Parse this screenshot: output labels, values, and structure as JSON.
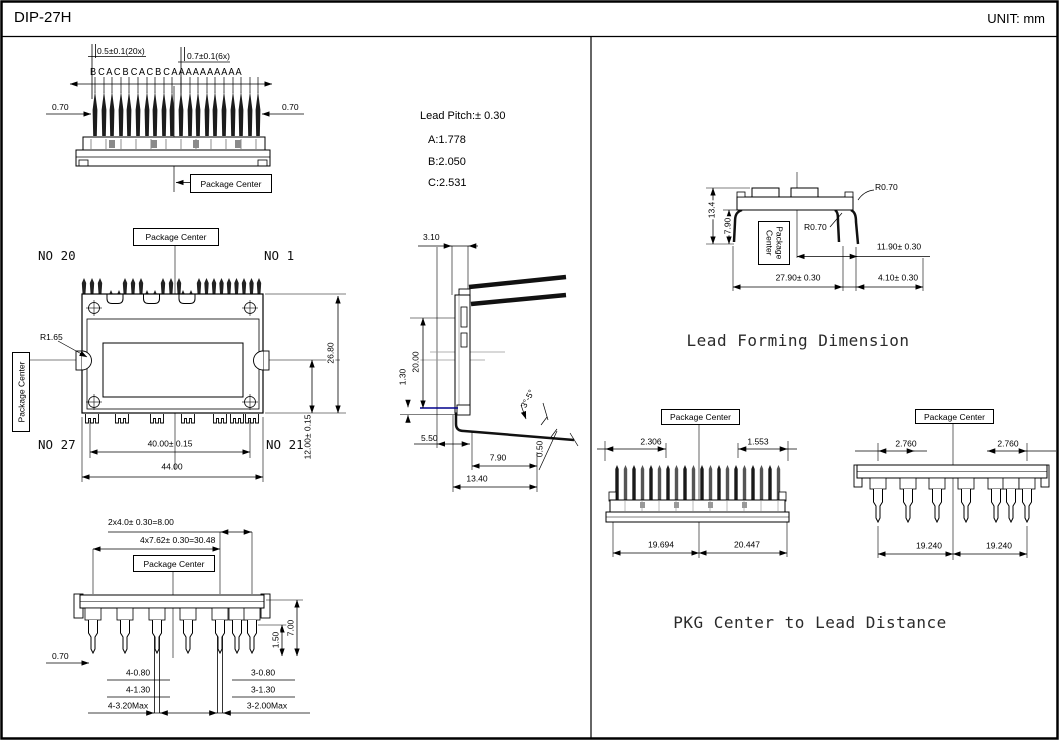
{
  "header": {
    "title": "DIP-27H",
    "unit": "UNIT: mm"
  },
  "front_view": {
    "pin_labels": "B C A C B C A C B C A A A A A A A A A A",
    "dim_tip20": "0.5±0.1(20x)",
    "dim_tip6": "0.7±0.1(6x)",
    "dim_left": "0.70",
    "dim_right": "0.70",
    "package_center": "Package Center"
  },
  "lead_pitch": {
    "title": "Lead Pitch:± 0.30",
    "a": "A:1.778",
    "b": "B:2.050",
    "c": "C:2.531"
  },
  "plan_view": {
    "package_center": "Package Center",
    "package_center_side": "Package Center",
    "no20": "NO 20",
    "no1": "NO 1",
    "no27": "NO 27",
    "no21": "NO 21",
    "radius": "R1.65",
    "lead_span": "40.00± 0.15",
    "body_width": "44.00",
    "body_height": "26.80",
    "lower_height": "12.00± 0.15"
  },
  "side_view": {
    "body_thickness": "3.10",
    "pin_length": "20.00",
    "standoff": "1.30",
    "d550": "5.50",
    "d790": "7.90",
    "d1340": "13.40",
    "d050": "0.50",
    "angle": "3°-5°"
  },
  "pin_view": {
    "dim_pitch2": "2x4.0± 0.30=8.00",
    "dim_pitch4": "4x7.62± 0.30=30.48",
    "package_center": "Package Center",
    "d070": "0.70",
    "d150": "1.50",
    "d700": "7.00",
    "rows_left": [
      "4-0.80",
      "4-1.30",
      "4-3.20Max"
    ],
    "rows_right": [
      "3-0.80",
      "3-1.30",
      "3-2.00Max"
    ]
  },
  "lead_forming": {
    "title": "Lead Forming Dimension",
    "d134": "13.4",
    "d790": "7.90",
    "r_top": "R0.70",
    "r_mid": "R0.70",
    "package_center": "Package Center",
    "d1190": "11.90± 0.30",
    "d2790": "27.90± 0.30",
    "d410": "4.10± 0.30"
  },
  "pkg_center": {
    "title": "PKG Center to Lead Distance",
    "left": {
      "package_center": "Package Center",
      "near": "2.306",
      "far": "1.553",
      "span_l": "19.694",
      "span_r": "20.447"
    },
    "right": {
      "package_center": "Package Center",
      "near_l": "2.760",
      "near_r": "2.760",
      "span_l": "19.240",
      "span_r": "19.240"
    }
  },
  "colors": {
    "line": "#000000",
    "lead_dark": "#111111",
    "navy_line": "#00008B",
    "cyan_mark": "#00AABB"
  }
}
